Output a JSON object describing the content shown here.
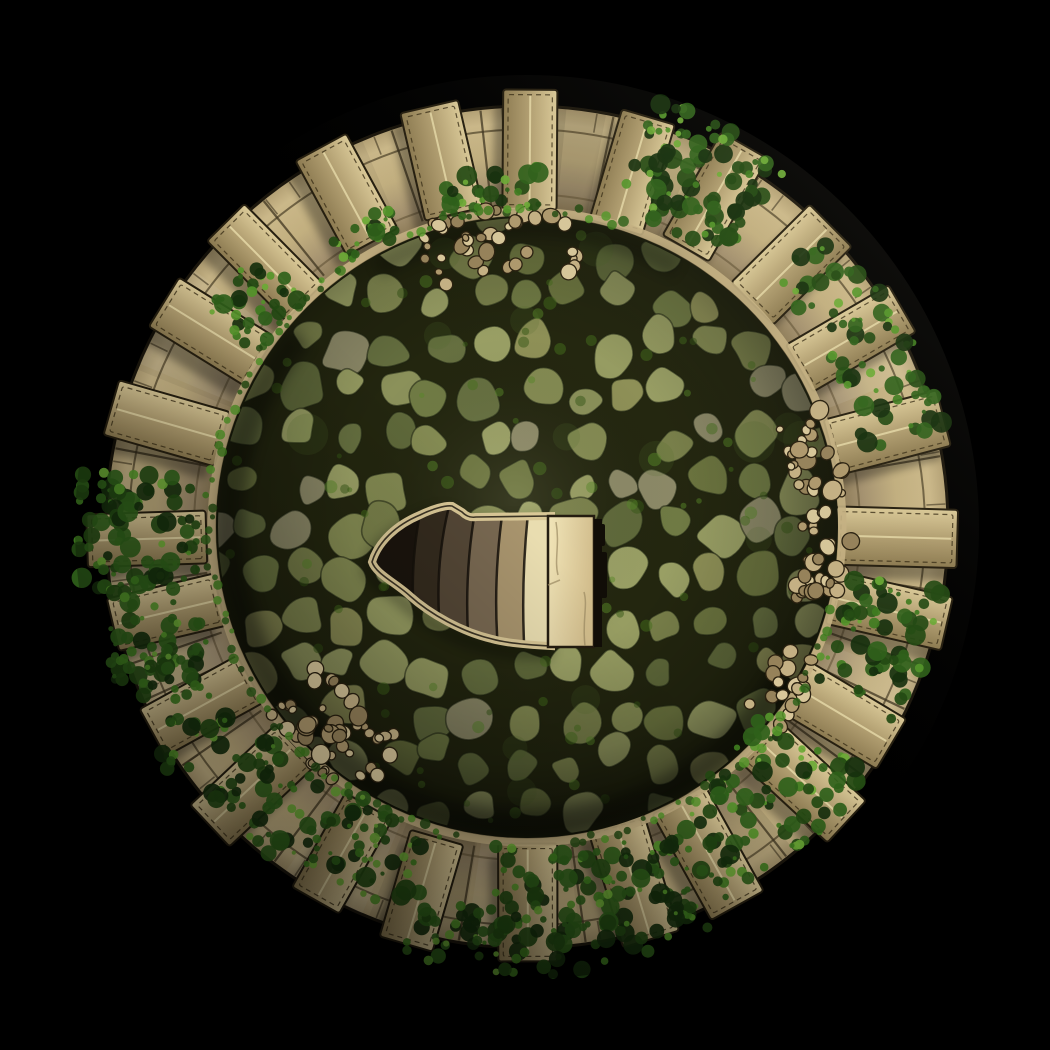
{
  "scene": {
    "description": "Top-down battle map tile: ruined circular stone tower rooftop with crenellated parapet, mossy flagstone courtyard, ivy, rubble, and a winding stair opening descending at the center",
    "canvas": {
      "width": 1050,
      "height": 1050,
      "background": "#000000"
    }
  },
  "tower": {
    "center": {
      "x": 527,
      "y": 527
    },
    "outer_radius": 452,
    "lighting": {
      "shadow_offset": {
        "dx": -9,
        "dy": 13
      },
      "shadow_opacity": 0.33
    },
    "walkway": {
      "outer_radius": 421,
      "inner_radius": 312,
      "edge_color": "#1c170d",
      "gradient": [
        [
          "0.72",
          "#7f6e49"
        ],
        [
          "0.80",
          "#a59270"
        ],
        [
          "0.88",
          "#c3b080"
        ],
        [
          "0.96",
          "#ccb98a"
        ],
        [
          "1",
          "#b3a074"
        ]
      ],
      "divider_color": "#3f3520",
      "divider_count": 40,
      "course_arc_radius": 398,
      "inner_arc_radius": 333,
      "joint_count": 60,
      "tone_wedge_count": 18
    },
    "rim": {
      "radius": 315.5,
      "width": 8,
      "color": "#c7b384"
    },
    "merlons": {
      "count": 24,
      "angle_step": 15,
      "radial_center": 374,
      "length": 116,
      "width": 57,
      "colors": {
        "bright": "#dccb99",
        "mid": "#b3a072",
        "dark": "#8d7b51",
        "edge": "#261f10",
        "ridge": "#e9ddab",
        "stitch": "#3b2f18"
      }
    }
  },
  "floor": {
    "radius": 311,
    "gap_color": "#23260f",
    "stone_palette": [
      "#79804a",
      "#8b915a",
      "#6c753f",
      "#979d62",
      "#5f693a",
      "#848b52",
      "#9aa065",
      "#707b44",
      "#8f9157",
      "#667040",
      "#8d8a68"
    ],
    "moss_palette": [
      "#466f1b",
      "#578727",
      "#365716"
    ],
    "grid_step": 46,
    "shade_center": {
      "x": 515,
      "y": 500
    }
  },
  "stairs": {
    "opening_path": "M372,562 C378,542 396,525 420,515 C432,509 446,505 452,506 L462,512 C466,516 470,518 476,517 L551,516 L551,646 C530,645 506,643 492,639 C462,632 430,614 410,596 C396,583 376,574 372,562 Z",
    "rim_color": "#d9c796",
    "rim_width": 8,
    "hole_color": "#1a140d",
    "step_edge_ys": [
      495,
      545,
      600,
      660
    ],
    "step_edges_x": [
      [
        424,
        412,
        408,
        420
      ],
      [
        452,
        438,
        434,
        444
      ],
      [
        478,
        468,
        464,
        470
      ],
      [
        505,
        497,
        493,
        499
      ],
      [
        530,
        524,
        521,
        525
      ]
    ],
    "step_colors": [
      "#342b1e",
      "#544736",
      "#786851",
      "#a8946d",
      "#e9ddb0"
    ],
    "edge_stroke": "#15100a",
    "landing": {
      "x": 548,
      "y": 516,
      "width": 46,
      "height": 131,
      "fill_light": "#f2e6b9",
      "fill_dark": "#d2bd8c",
      "stroke": "#241c10",
      "crack_color": "#9b8a63"
    },
    "gap_strip": {
      "x": 594,
      "y": 519,
      "width": 8,
      "height": 128,
      "color": "#110d07"
    }
  },
  "ivy": {
    "palette": [
      "#16300d",
      "#234a12",
      "#2f611a",
      "#3f7d1f",
      "#55962a",
      "#6cab36"
    ],
    "clusters": [
      {
        "angle": 64,
        "r1": 330,
        "r2": 448,
        "spread": 10,
        "density": 95
      },
      {
        "angle": 29,
        "r1": 345,
        "r2": 428,
        "spread": 16,
        "density": 75
      },
      {
        "angle": 342,
        "r1": 325,
        "r2": 420,
        "spread": 10,
        "density": 60
      },
      {
        "angle": 315,
        "r1": 300,
        "r2": 425,
        "spread": 9,
        "density": 65
      },
      {
        "angle": 298,
        "r1": 330,
        "r2": 420,
        "spread": 8,
        "density": 45
      },
      {
        "angle": 287,
        "r1": 330,
        "r2": 445,
        "spread": 8,
        "density": 60
      },
      {
        "angle": 272,
        "r1": 320,
        "r2": 450,
        "spread": 8,
        "density": 70
      },
      {
        "angle": 258,
        "r1": 380,
        "r2": 450,
        "spread": 6,
        "density": 30
      },
      {
        "angle": 243,
        "r1": 315,
        "r2": 405,
        "spread": 9,
        "density": 60
      },
      {
        "angle": 226,
        "r1": 330,
        "r2": 420,
        "spread": 8,
        "density": 45
      },
      {
        "angle": 180,
        "r1": 330,
        "r2": 450,
        "spread": 9,
        "density": 75
      },
      {
        "angle": 194,
        "r1": 340,
        "r2": 435,
        "spread": 9,
        "density": 55
      },
      {
        "angle": 207,
        "r1": 345,
        "r2": 440,
        "spread": 9,
        "density": 55
      },
      {
        "angle": 140,
        "r1": 318,
        "r2": 385,
        "spread": 7,
        "density": 35
      },
      {
        "angle": 97,
        "r1": 316,
        "r2": 360,
        "spread": 10,
        "density": 30
      },
      {
        "angle": 119,
        "r1": 316,
        "r2": 350,
        "spread": 6,
        "density": 20
      }
    ]
  },
  "rubble": {
    "palette": [
      "#d9c89b",
      "#c6b285",
      "#b09a6e",
      "#97835b"
    ],
    "stroke": "#2a2110",
    "clusters": [
      {
        "angle": 95,
        "r1": 255,
        "r2": 320,
        "spread": 16,
        "count": 42
      },
      {
        "angle": 226,
        "r1": 245,
        "r2": 320,
        "spread": 13,
        "count": 46
      },
      {
        "angle": 354,
        "r1": 275,
        "r2": 330,
        "spread": 9,
        "count": 30
      },
      {
        "angle": 14,
        "r1": 270,
        "r2": 325,
        "spread": 8,
        "count": 24
      },
      {
        "angle": 328,
        "r1": 280,
        "r2": 325,
        "spread": 7,
        "count": 18
      }
    ]
  },
  "moss_fringe": {
    "arcs": [
      {
        "from": 72,
        "to": 112
      },
      {
        "from": 125,
        "to": 258
      },
      {
        "from": 278,
        "to": 345
      }
    ]
  }
}
